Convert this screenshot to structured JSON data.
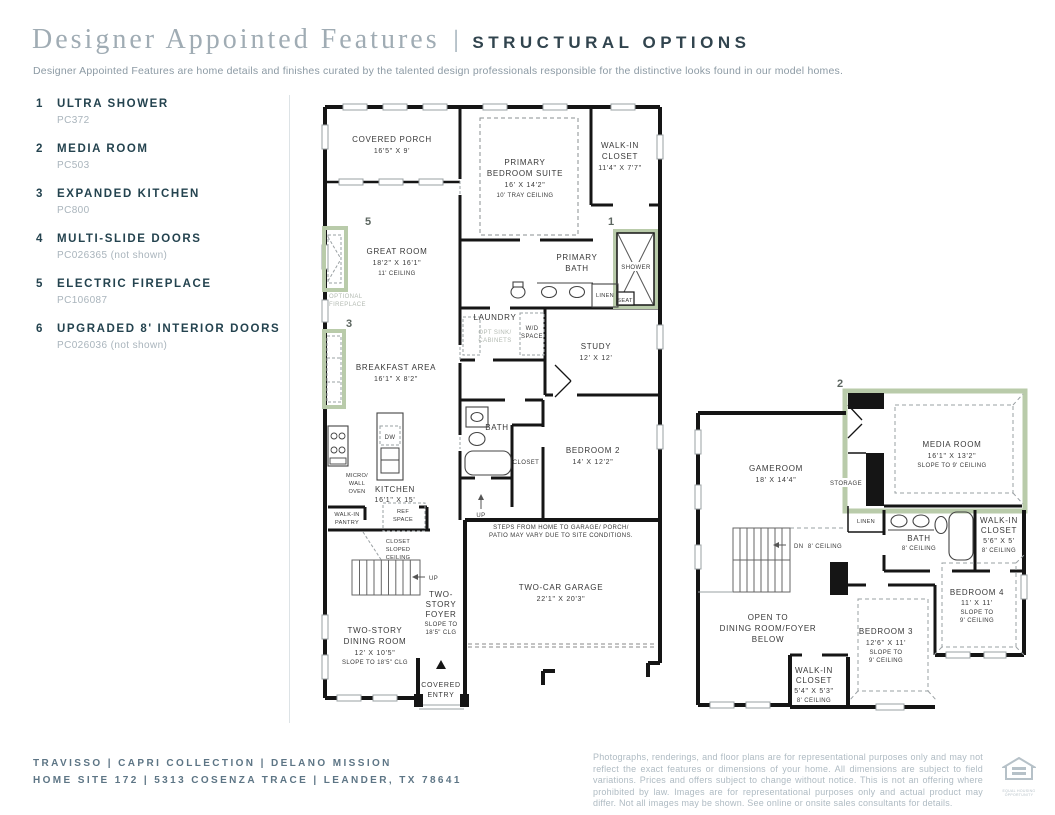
{
  "header": {
    "brand_title": "Designer Appointed Features",
    "divider": "|",
    "section_title": "STRUCTURAL OPTIONS",
    "subtitle": "Designer Appointed Features are home details and finishes curated by the talented design professionals responsible for the distinctive looks found in our model homes."
  },
  "features": [
    {
      "num": "1",
      "name": "ULTRA SHOWER",
      "code": "PC372"
    },
    {
      "num": "2",
      "name": "MEDIA ROOM",
      "code": "PC503"
    },
    {
      "num": "3",
      "name": "EXPANDED KITCHEN",
      "code": "PC800"
    },
    {
      "num": "4",
      "name": "MULTI-SLIDE DOORS",
      "code": "PC026365 (not shown)"
    },
    {
      "num": "5",
      "name": "ELECTRIC FIREPLACE",
      "code": "PC106087"
    },
    {
      "num": "6",
      "name": "UPGRADED 8' INTERIOR DOORS",
      "code": "PC026036 (not shown)"
    }
  ],
  "markers": {
    "ultra_shower": "1",
    "media_room": "2",
    "expanded_kitchen": "3",
    "electric_fireplace": "5"
  },
  "plan1": {
    "covered_porch": [
      "COVERED PORCH",
      "16'5\" X 9'"
    ],
    "primary_suite": [
      "PRIMARY",
      "BEDROOM SUITE",
      "16' X 14'2\"",
      "10' TRAY CEILING"
    ],
    "walk_in_closet": [
      "WALK-IN",
      "CLOSET",
      "11'4\" X 7'7\""
    ],
    "great_room": [
      "GREAT ROOM",
      "18'2\" X 16'1\"",
      "11' CEILING"
    ],
    "optional_fireplace": [
      "OPTIONAL",
      "FIREPLACE"
    ],
    "primary_bath": [
      "PRIMARY",
      "BATH"
    ],
    "shower": "SHOWER",
    "seat": "SEAT",
    "linen": "LINEN",
    "laundry": "LAUNDRY",
    "opt_sink": [
      "OPT SINK/",
      "CABINETS"
    ],
    "wd_space": [
      "W/D",
      "SPACE"
    ],
    "study": [
      "STUDY",
      "12' X 12'"
    ],
    "breakfast": [
      "BREAKFAST AREA",
      "16'1\" X 8'2\""
    ],
    "bath": "BATH",
    "closet": "CLOSET",
    "bedroom2": [
      "BEDROOM 2",
      "14' X 12'2\""
    ],
    "micro": [
      "MICRO/",
      "WALL",
      "OVEN"
    ],
    "kitchen": [
      "KITCHEN",
      "16'1\" X 15'"
    ],
    "pantry": [
      "WALK-IN",
      "PANTRY"
    ],
    "ref": [
      "REF",
      "SPACE"
    ],
    "dw": "DW",
    "closet_sloped": [
      "CLOSET",
      "SLOPED",
      "CEILING"
    ],
    "up": "UP",
    "foyer": [
      "TWO-",
      "STORY",
      "FOYER",
      "SLOPE TO",
      "18'5\" CLG"
    ],
    "dining": [
      "TWO-STORY",
      "DINING ROOM",
      "12' X 10'5\"",
      "SLOPE TO 18'5\" CLG"
    ],
    "garage": [
      "TWO-CAR GARAGE",
      "22'1\" X 20'3\""
    ],
    "steps_note": [
      "STEPS FROM HOME TO GARAGE/ PORCH/",
      "PATIO MAY VARY DUE TO SITE CONDITIONS."
    ],
    "covered_entry": [
      "COVERED",
      "ENTRY"
    ]
  },
  "plan2": {
    "gameroom": [
      "GAMEROOM",
      "18' X 14'4\""
    ],
    "media_room": [
      "MEDIA ROOM",
      "16'1\" X 13'2\"",
      "SLOPE TO 9' CEILING"
    ],
    "storage": "STORAGE",
    "linen": "LINEN",
    "bath": [
      "BATH",
      "8' CEILING"
    ],
    "wic_upper": [
      "WALK-IN",
      "CLOSET",
      "5'6\" X 5'",
      "8' CEILING"
    ],
    "dn": "DN",
    "ceiling8": "8' CEILING",
    "open_to": [
      "OPEN TO",
      "DINING ROOM/FOYER",
      "BELOW"
    ],
    "wic_lower": [
      "WALK-IN",
      "CLOSET",
      "5'4\" X 5'3\"",
      "8' CEILING"
    ],
    "bedroom3": [
      "BEDROOM 3",
      "12'6\" X 11'",
      "SLOPE TO",
      "9' CEILING"
    ],
    "bedroom4": [
      "BEDROOM 4",
      "11' X 11'",
      "SLOPE TO",
      "9' CEILING"
    ]
  },
  "footer": {
    "community_line": "TRAVISSO   |   CAPRI COLLECTION   |   DELANO MISSION",
    "address_line": "HOME SITE 172   |   5313 COSENZA TRACE   |   LEANDER, TX 78641",
    "disclaimer": "Photographs, renderings, and floor plans are for representational purposes only and may not reflect the exact features or dimensions of your home. All dimensions are subject to field variations. Prices and offers subject to change without notice. This is not an offering where prohibited by law. Images are for representational purposes only and actual product may differ. Not all images may be shown. See online or onsite sales consultants for details.",
    "equal_housing": "EQUAL HOUSING OPPORTUNITY"
  },
  "colors": {
    "accent_green": "#b9cbaa",
    "wall_ink": "#151515",
    "label_ink": "#383838",
    "title_gray": "#a0acb4",
    "caps_dark": "#31444e",
    "navy": "#24434f",
    "slate": "#5d7585",
    "muted_gray": "#afbbc3"
  }
}
